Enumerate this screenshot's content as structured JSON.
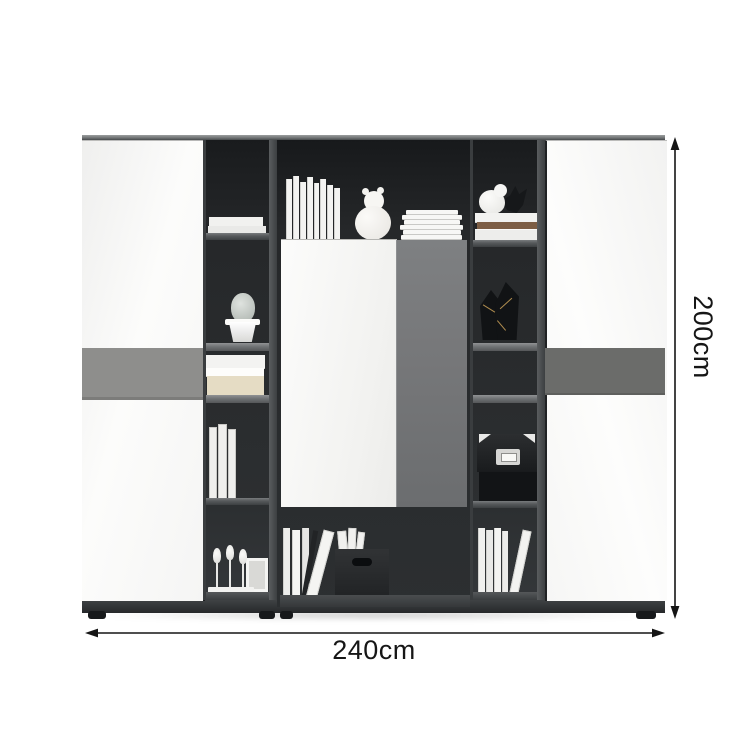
{
  "image_type": "furniture-product-dimension-image",
  "dims": {
    "width_label": "240cm",
    "height_label": "200cm"
  },
  "colors": {
    "background": "#ffffff",
    "dark_interior": "#26282a",
    "carcass_frame_gray": "#55585a",
    "white_door": "#f9f9f8",
    "gray_door": "#77787a",
    "accent_band_left": "#8e8e8c",
    "accent_band_right": "#6b6c6a",
    "base_plinth": "#2e3133",
    "dimension_lines": "#151515",
    "beige_book": "#e5dcc4",
    "brown_book": "#7d5e45",
    "gold_accent": "#b08d4f"
  },
  "cabinet": {
    "left_column_items": [
      "white storage boxes",
      "cactus in white pot",
      "stacked white and beige books",
      "standing white books",
      "white candlestick decor set with picture frame"
    ],
    "middle_top_items": [
      "row of standing white books",
      "white teddy bear figurine",
      "stack of white books"
    ],
    "middle_doors": [
      "white cabinet door",
      "gray cabinet door"
    ],
    "middle_bottom_items": [
      "standing white books",
      "leaning white book",
      "black fabric storage box with papers"
    ],
    "right_column_items": [
      "white bird figurine",
      "black bird figurine",
      "stack of books with brown book",
      "black geometric vases with gold trim",
      "black file box with metal label",
      "standing white books"
    ]
  }
}
